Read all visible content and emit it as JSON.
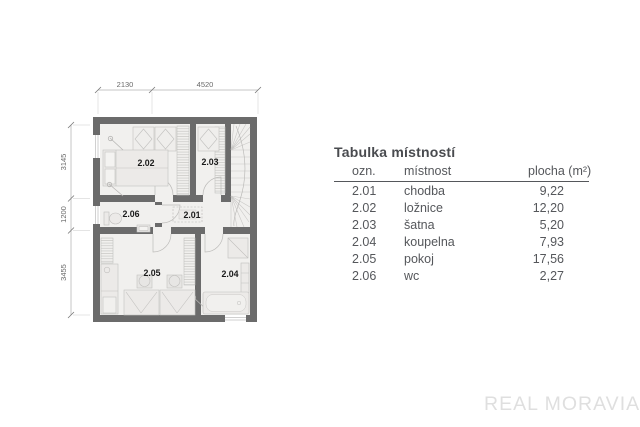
{
  "floorplan": {
    "room_labels": {
      "r201": "2.01",
      "r202": "2.02",
      "r203": "2.03",
      "r204": "2.04",
      "r205": "2.05",
      "r206": "2.06"
    },
    "dimensions": {
      "top": [
        "2130",
        "4520"
      ],
      "left": [
        "3145",
        "1200",
        "3455"
      ]
    },
    "colors": {
      "wall": "#6b6b6b",
      "floor": "#f1f0ee",
      "furniture_line": "#c2c1bf",
      "label": "#1a1a1a",
      "dimension": "#8e8e8e"
    }
  },
  "table": {
    "title": "Tabulka místností",
    "columns": {
      "ozn": "ozn.",
      "mistnost": "místnost",
      "plocha": "plocha (m²)"
    },
    "rows": [
      {
        "ozn": "2.01",
        "mistnost": "chodba",
        "plocha": "9,22"
      },
      {
        "ozn": "2.02",
        "mistnost": "ložnice",
        "plocha": "12,20"
      },
      {
        "ozn": "2.03",
        "mistnost": "šatna",
        "plocha": "5,20"
      },
      {
        "ozn": "2.04",
        "mistnost": "koupelna",
        "plocha": "7,93"
      },
      {
        "ozn": "2.05",
        "mistnost": "pokoj",
        "plocha": "17,56"
      },
      {
        "ozn": "2.06",
        "mistnost": "wc",
        "plocha": "2,27"
      }
    ],
    "text_color": "#55575b"
  },
  "watermark": "REAL MORAVIA"
}
